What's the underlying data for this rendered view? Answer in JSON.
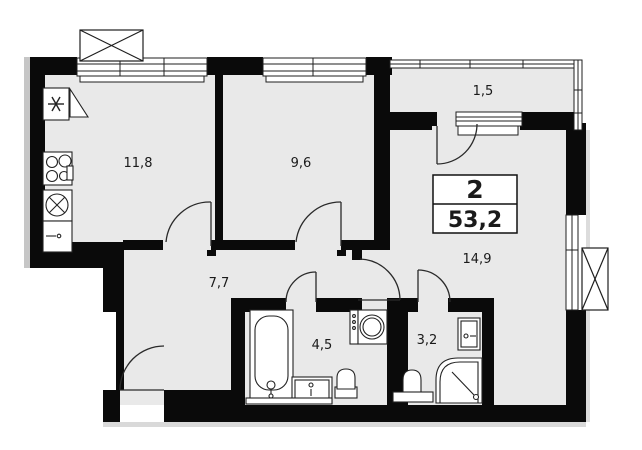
{
  "plan": {
    "type": "apartment-floor-plan",
    "title_box": {
      "rooms_count": "2",
      "total_area": "53,2"
    },
    "rooms": [
      {
        "name": "kitchen-living",
        "area": "11,8"
      },
      {
        "name": "bedroom",
        "area": "9,6"
      },
      {
        "name": "balcony",
        "area": "1,5"
      },
      {
        "name": "living-room",
        "area": "14,9"
      },
      {
        "name": "hallway",
        "area": "7,7"
      },
      {
        "name": "bathroom",
        "area": "4,5"
      },
      {
        "name": "shower-room",
        "area": "3,2"
      }
    ],
    "colors": {
      "wall": "#0a0a0a",
      "floor": "#e9e9e9",
      "line": "#2a2a2a",
      "shadow": "#c6c6c6",
      "paper": "#ffffff"
    }
  }
}
